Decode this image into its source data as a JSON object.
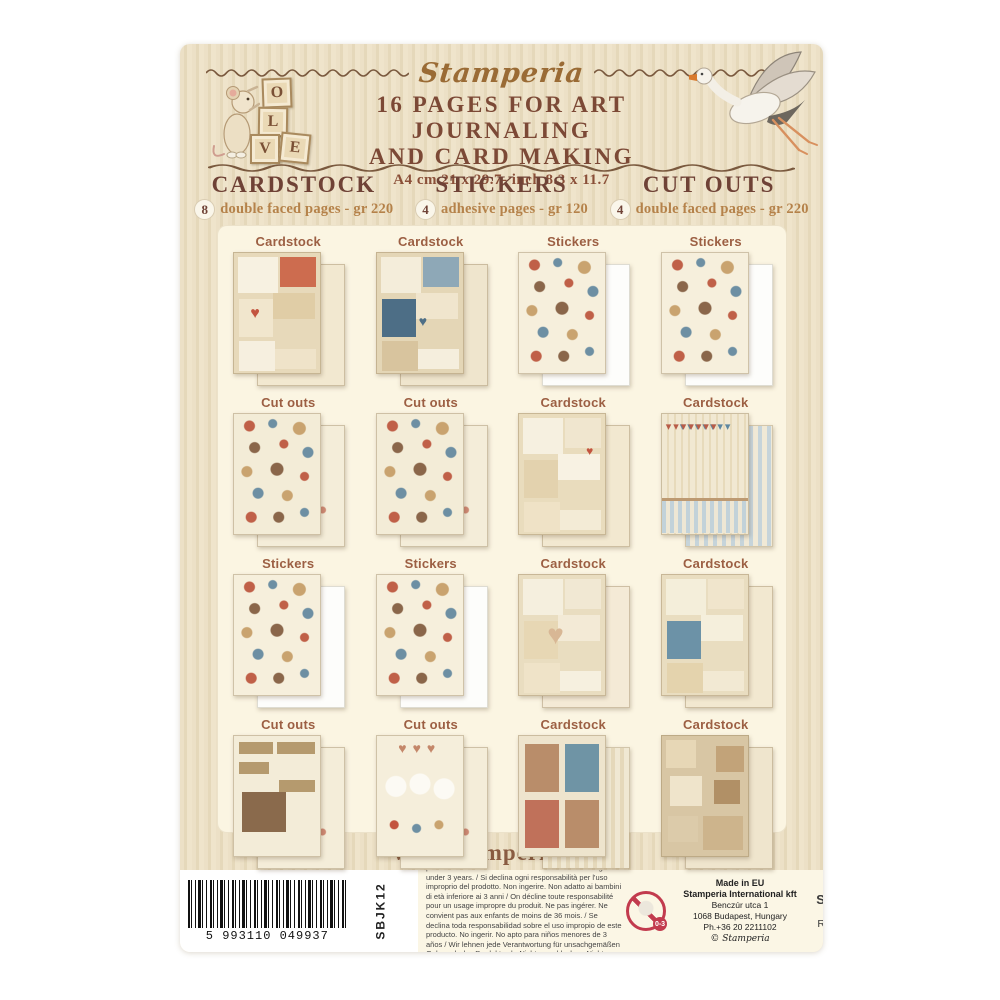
{
  "header": {
    "brand": "Stamperia",
    "blocks": [
      "O",
      "L",
      "V",
      "E"
    ],
    "title1": "16 PAGES FOR ART JOURNALING",
    "title2": "AND CARD MAKING",
    "size": "A4 cm 21 x 29.7- inch 8.3 x 11.7"
  },
  "categories": [
    {
      "name": "CARDSTOCK",
      "count": "8",
      "desc": "double faced pages - gr 220"
    },
    {
      "name": "STICKERS",
      "count": "4",
      "desc": "adhesive pages - gr 120"
    },
    {
      "name": "CUT OUTS",
      "count": "4",
      "desc": "double faced pages - gr 220"
    }
  ],
  "grid": {
    "cells": [
      {
        "label": "Cardstock"
      },
      {
        "label": "Cardstock"
      },
      {
        "label": "Stickers"
      },
      {
        "label": "Stickers"
      },
      {
        "label": "Cut outs"
      },
      {
        "label": "Cut outs"
      },
      {
        "label": "Cardstock"
      },
      {
        "label": "Cardstock"
      },
      {
        "label": "Stickers"
      },
      {
        "label": "Stickers"
      },
      {
        "label": "Cardstock"
      },
      {
        "label": "Cardstock"
      },
      {
        "label": "Cut outs"
      },
      {
        "label": "Cut outs"
      },
      {
        "label": "Cardstock"
      },
      {
        "label": "Cardstock"
      }
    ]
  },
  "footer": {
    "website": "www.stamperia.com",
    "barcode": "5 993110 049937",
    "code": "SBJK12",
    "legal": "We decline all responsibility for improper use of the product. Do not swallow. Unsuitable for children of age under 3 years. / Si declina ogni responsabilità per l'uso improprio del prodotto. Non ingerire. Non adatto ai bambini di età inferiore ai 3 anni / On décline toute responsabilité pour un usage impropre du produit. Ne pas ingérer. Ne convient pas aux enfants de moins de 36 mois. / Se declina toda responsabilidad sobre el uso impropio de este producto. No ingerir. No apto para niños menores de 3 años / Wir lehnen jede Verantwortung für unsachgemäßen Gebrauch des Produkts ab. Nicht verschlucken. Nicht geeignet für Kinder unter 3 Jahren.",
    "age": "0-3",
    "made_in": "Made in EU",
    "company": "Stamperia International kft",
    "addr1": "Benczúr utca 1",
    "addr2": "1068 Budapest, Hungary",
    "phone": "Ph.+36 20 2211102",
    "copyright": "© Stamperia",
    "scan1": "SCAN ME",
    "scan2": "BEFORE",
    "scan3": "RECYCLING"
  },
  "colors": {
    "package_bg": "#e9dcc0",
    "panel_bg": "#fbf5e2",
    "title_brown": "#7c4936",
    "accent_tan": "#b5824a",
    "label_brown": "#9c5f43",
    "red": "#c9604a",
    "blue": "#5e87a0",
    "strip_bg": "#fbf6e5"
  }
}
